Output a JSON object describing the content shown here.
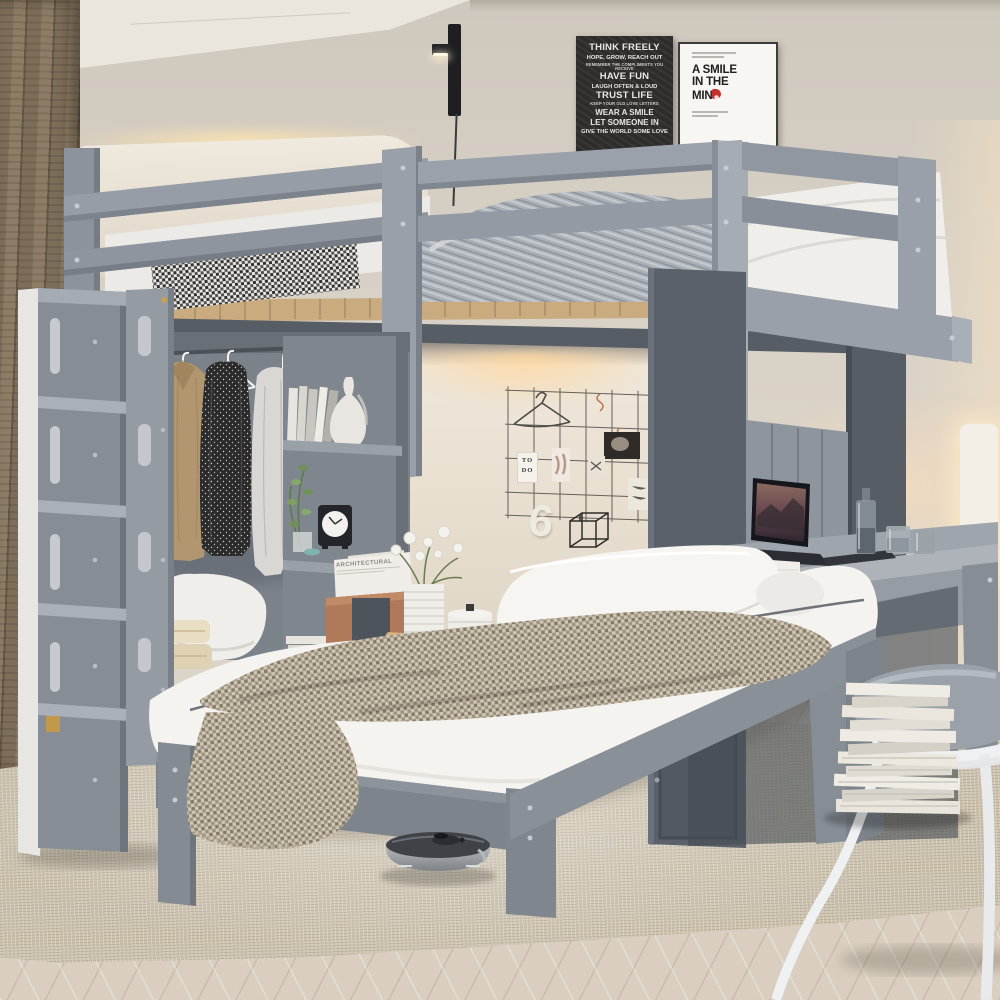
{
  "posters": {
    "black": {
      "lines": [
        "THINK FREELY",
        "HOPE, GROW, REACH OUT",
        "REMEMBER THE COMPLIMENTS YOU RECEIVE",
        "HAVE FUN",
        "LAUGH OFTEN & LOUD",
        "TRUST LIFE",
        "KEEP YOUR OLD LOVE LETTERS",
        "WEAR A SMILE",
        "LET SOMEONE IN",
        "GIVE THE WORLD SOME LOVE"
      ]
    },
    "white": {
      "line1": "A SMILE",
      "line2": "IN THE",
      "line3_prefix": "MIN",
      "line3_suffix": "D"
    }
  },
  "wall_decor": {
    "todo_card": {
      "line1": "TO",
      "line2": "DO"
    },
    "number": "6"
  },
  "shelf": {
    "magazine_title": "ARCHITECTURAL"
  },
  "palette": {
    "wall": "#d8d1c6",
    "ceiling": "#eae6de",
    "curtain_wood": "#8d7d66",
    "furniture_gray_light": "#9ba1a9",
    "furniture_gray_mid": "#8a9098",
    "furniture_gray_dark": "#5a616a",
    "bedding_white": "#f4f3f0",
    "throw_beige": "#cfc5b1",
    "accent_red": "#c5302c",
    "led_glow": "#ffd9a0",
    "wood_slats": "#c9ab7f",
    "leather": "#b0795a",
    "floor": "#d9cec0",
    "rug": "#cdc3af"
  }
}
